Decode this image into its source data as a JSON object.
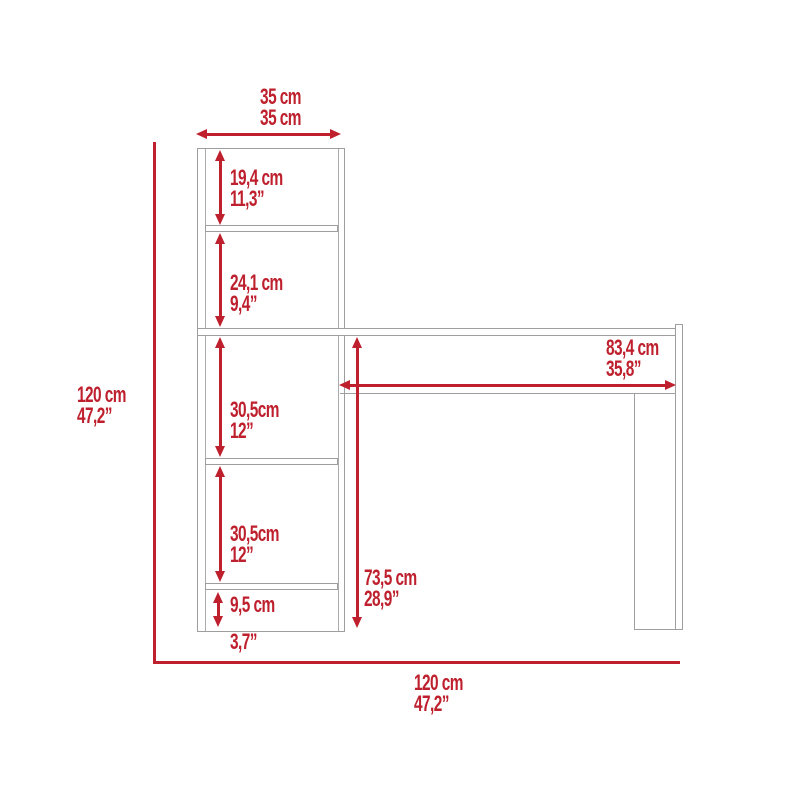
{
  "title": "Corner desk with bookcase - dimension diagram",
  "colors": {
    "dimension_red": "#be202e",
    "furniture_gray": "#9e9e9e",
    "background": "#ffffff"
  },
  "overall": {
    "top_width": {
      "line1": "35 cm",
      "line2": "35 cm"
    },
    "height": {
      "line1": "120 cm",
      "line2": "47,2”"
    },
    "width": {
      "line1": "120 cm",
      "line2": "47,2”"
    }
  },
  "bookcase_sections": [
    {
      "cm": "19,4 cm",
      "inch": "11,3”"
    },
    {
      "cm": "24,1 cm",
      "inch": "9,4”"
    },
    {
      "cm": "30,5cm",
      "inch": "12”"
    },
    {
      "cm": "30,5cm",
      "inch": "12”"
    },
    {
      "cm": "9,5 cm",
      "inch": "3,7”"
    }
  ],
  "desk": {
    "width": {
      "line1": "83,4 cm",
      "line2": "35,8”"
    },
    "height": {
      "line1": "73,5 cm",
      "line2": "28,9”"
    }
  }
}
